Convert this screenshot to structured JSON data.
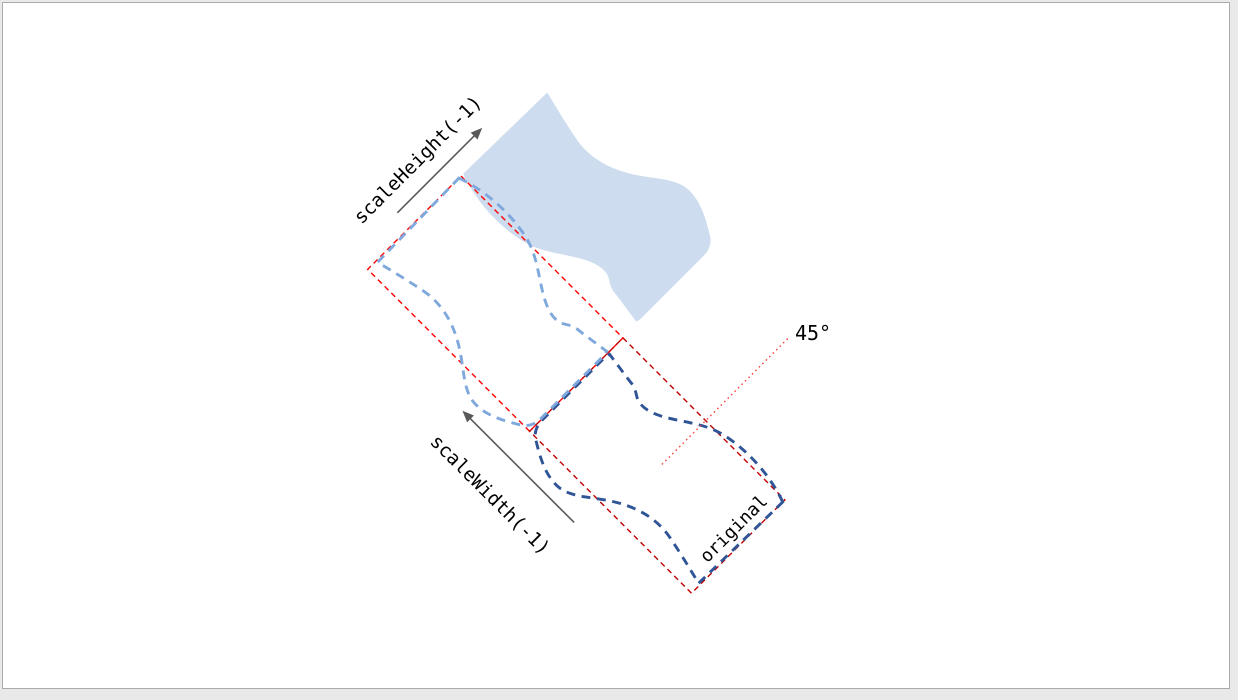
{
  "colors": {
    "page_bg": "#e9e9e9",
    "canvas_bg": "#ffffff",
    "canvas_border": "#ababab",
    "wave_fill": "#cddcee",
    "flip_outline": "#7fa8dc",
    "original_outline": "#2f5597",
    "flip_bounds": "#ff0000",
    "original_bounds": "#c00000",
    "angle_line": "#ff3b30",
    "arrow": "#595959",
    "text": "#000000"
  },
  "labels": {
    "scale_height": "scaleHeight(-1)",
    "scale_width": "scaleWidth(-1)",
    "original": "original",
    "angle": "45°"
  },
  "diagram": {
    "rotation_deg": 45
  }
}
